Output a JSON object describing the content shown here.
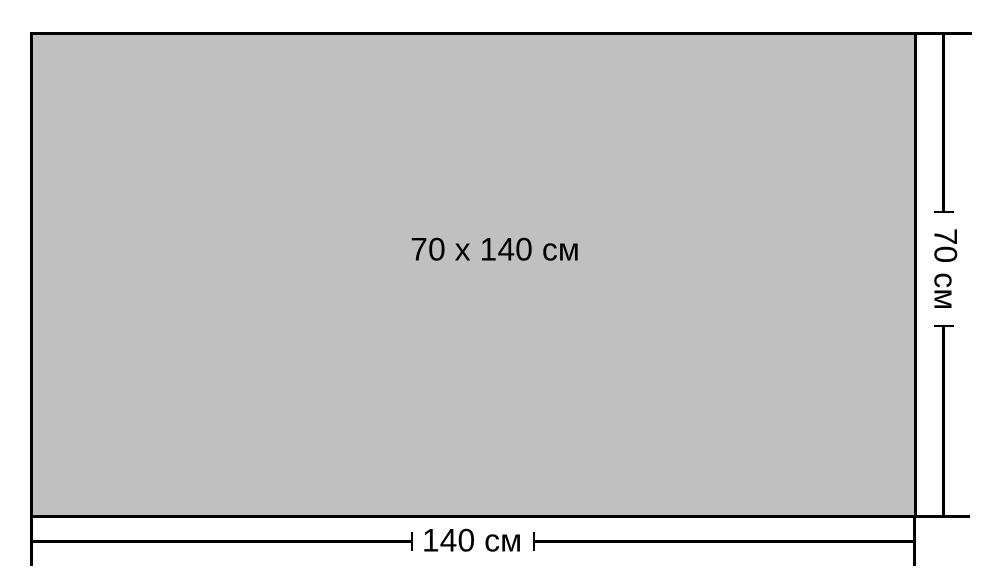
{
  "diagram": {
    "center_label": "70 x 140 см",
    "width_dimension": {
      "label": "140 см"
    },
    "height_dimension": {
      "label": "70 см"
    },
    "colors": {
      "fill": "#c0c0c0",
      "line": "#000000",
      "text": "#000000",
      "background": "#ffffff"
    }
  }
}
